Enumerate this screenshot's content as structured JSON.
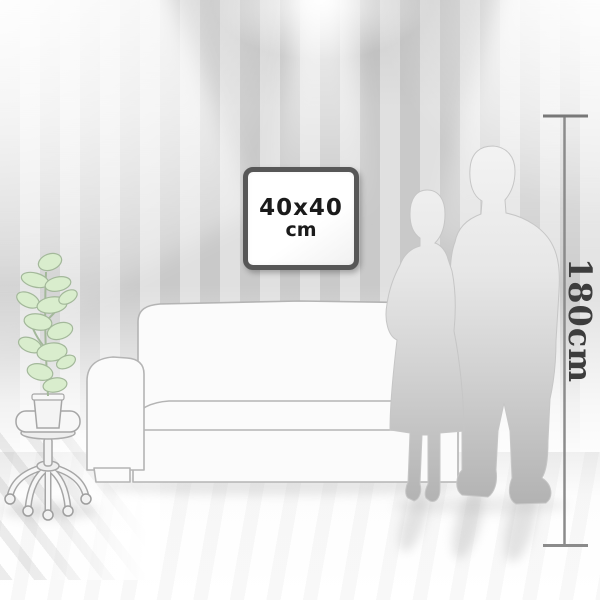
{
  "scene": {
    "description": "room size visualization with framed picture, sofa, plant on stool, couple silhouette and height ruler",
    "frame": {
      "size_label": "40x40",
      "unit_label": "cm"
    },
    "ruler": {
      "label": "180cm"
    },
    "colors": {
      "wall_stripe_dark": "#c9c9c9",
      "wall_stripe_light": "#e0e0e0",
      "floor": "#ffffff",
      "frame_border": "#575757",
      "frame_text": "#1b1b1b",
      "ruler_line": "#8b8b8b",
      "ruler_text": "#3d3d3d",
      "plant_leaf": "#d9edcd",
      "plant_outline": "#a3b89a",
      "furniture_fill": "#fbfbfb",
      "furniture_outline": "#b4b4b4",
      "silhouette_top": "#f2f2f2",
      "silhouette_bottom": "#b2b2b2"
    }
  }
}
